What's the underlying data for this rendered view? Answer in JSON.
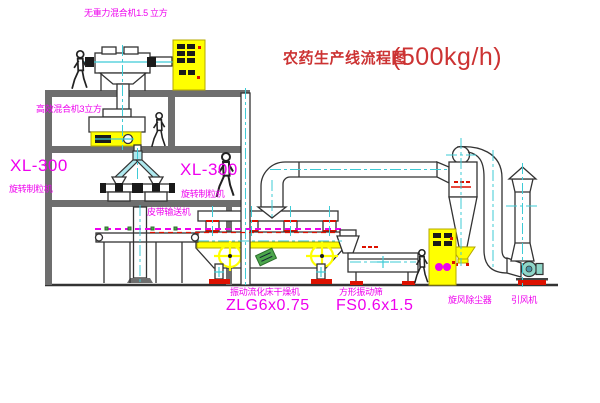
{
  "title": {
    "text": "农药生产线流程图",
    "capacity": "(500kg/h)"
  },
  "equipment_labels": {
    "gravity_mixer": "无重力混合机1.5 立方",
    "high_eff_mixer": "高效混合机3立方",
    "granulator_left_model": "XL-300",
    "granulator_left_name": "旋转制粒机",
    "granulator_right_model": "XL-300",
    "granulator_right_name": "旋转制粒机",
    "belt_conveyor": "皮带输送机",
    "dryer_name": "振动流化床干燥机",
    "dryer_model": "ZLG6x0.75",
    "sieve_name": "方形振动筛",
    "sieve_model": "FS0.6x1.5",
    "cyclone": "旋风除尘器",
    "fan": "引风机"
  },
  "colors": {
    "label": "#ee00ee",
    "title": "#cc3333",
    "centerline": "#3ecbd6",
    "highlight": "#ffff00",
    "flange": "#dd1100",
    "machine_green": "#4ca64c"
  }
}
